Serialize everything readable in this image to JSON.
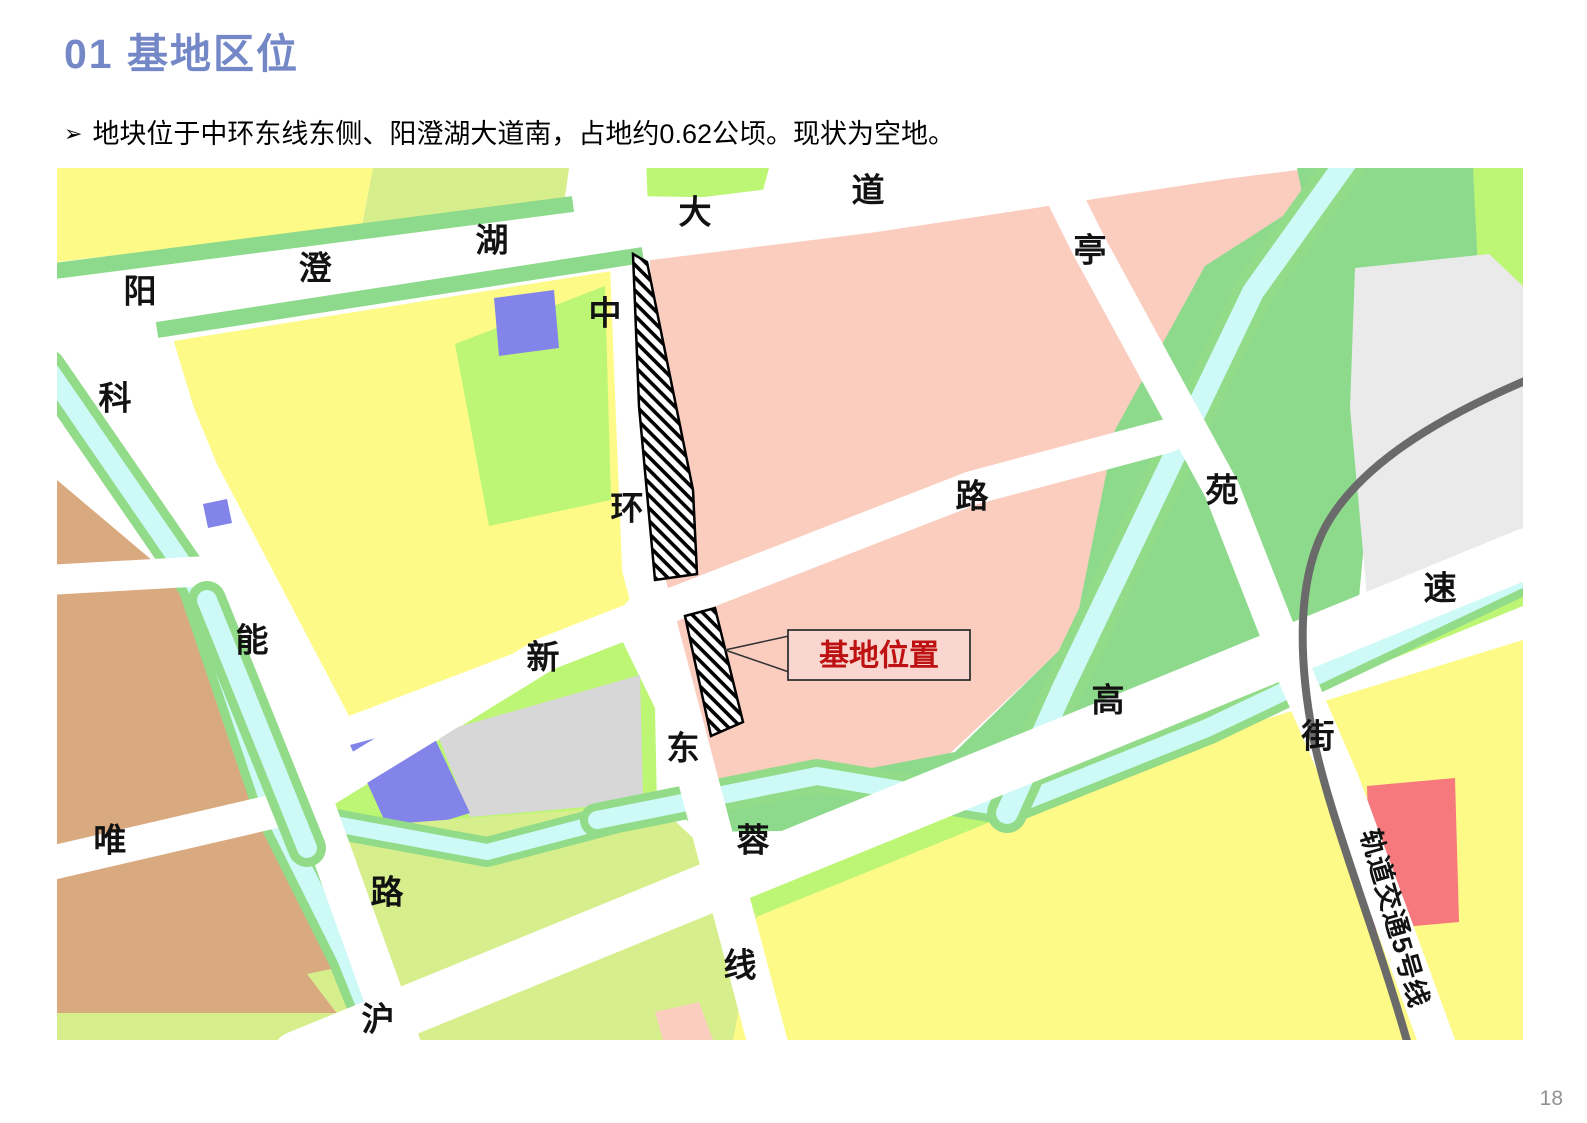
{
  "page": {
    "title": "01 基地区位",
    "bullet_marker": "➢",
    "bullet_text": "地块位于中环东线东侧、阳澄湖大道南，占地约0.62公顷。现状为空地。",
    "page_number": "18"
  },
  "map": {
    "annotation": {
      "site_label": "基地位置"
    },
    "metro_line_label": "轨道交通5号线",
    "road_labels": [
      {
        "name": "阳澄湖大道",
        "chars": [
          {
            "ch": "阳",
            "x": 83,
            "y": 123
          },
          {
            "ch": "澄",
            "x": 258,
            "y": 100
          },
          {
            "ch": "湖",
            "x": 435,
            "y": 72
          },
          {
            "ch": "大",
            "x": 638,
            "y": 44
          },
          {
            "ch": "道",
            "x": 811,
            "y": 22
          }
        ]
      },
      {
        "name": "中环东线",
        "chars": [
          {
            "ch": "中",
            "x": 548,
            "y": 145
          },
          {
            "ch": "环",
            "x": 570,
            "y": 340
          },
          {
            "ch": "东",
            "x": 626,
            "y": 580
          },
          {
            "ch": "线",
            "x": 683,
            "y": 797
          }
        ]
      },
      {
        "name": "唯新路",
        "chars": [
          {
            "ch": "唯",
            "x": 53,
            "y": 672
          },
          {
            "ch": "新",
            "x": 486,
            "y": 489
          },
          {
            "ch": "路",
            "x": 915,
            "y": 328
          }
        ]
      },
      {
        "name": "科能路",
        "chars": [
          {
            "ch": "科",
            "x": 58,
            "y": 230
          },
          {
            "ch": "能",
            "x": 195,
            "y": 472
          },
          {
            "ch": "路",
            "x": 330,
            "y": 724
          }
        ]
      },
      {
        "name": "沪蓉高速",
        "chars": [
          {
            "ch": "沪",
            "x": 321,
            "y": 851
          },
          {
            "ch": "蓉",
            "x": 696,
            "y": 672
          },
          {
            "ch": "高",
            "x": 1051,
            "y": 532
          },
          {
            "ch": "速",
            "x": 1383,
            "y": 420
          }
        ]
      },
      {
        "name": "亭苑街",
        "chars": [
          {
            "ch": "亭",
            "x": 1033,
            "y": 82
          },
          {
            "ch": "苑",
            "x": 1165,
            "y": 322
          },
          {
            "ch": "街",
            "x": 1261,
            "y": 568
          }
        ]
      }
    ],
    "colors": {
      "title_blue": "#7487C6",
      "road_white": "#FFFFFF",
      "parcel_yellow": "#FDFA87",
      "parcel_olive": "#D6EE8B",
      "parcel_bright_green": "#BDF675",
      "parcel_medium_green": "#8EDA8C",
      "canal_cyan": "#CDF9F6",
      "canal_green_edge": "#92DB88",
      "parcel_brown": "#D9AA7F",
      "parcel_purple": "#8384EA",
      "parcel_pink": "#FACDBF",
      "parcel_gray_small": "#D7D7D7",
      "parcel_gray_big": "#EAEAEA",
      "parcel_red": "#F5797D",
      "railway_gray": "#6A6A6A",
      "site_box_fill": "#F9D7D0",
      "site_text_red": "#BE1212"
    }
  }
}
